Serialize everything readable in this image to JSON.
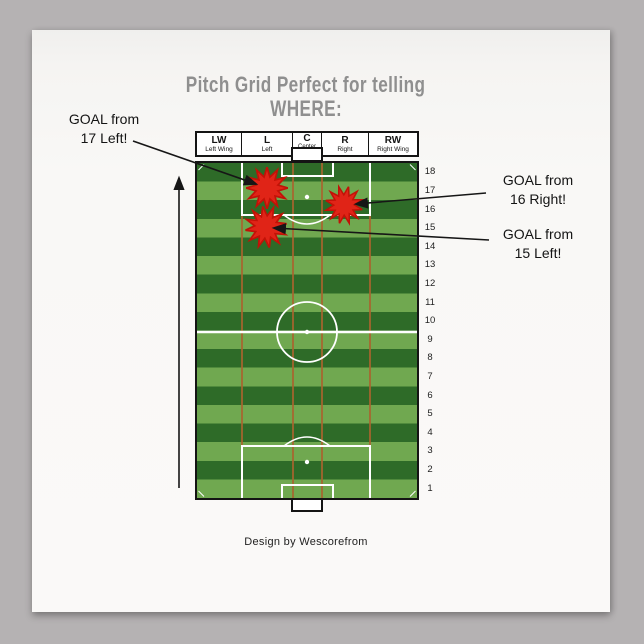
{
  "poster": {
    "title_line1": "Pitch Grid Perfect for telling",
    "title_line2": "WHERE:",
    "credit": "Design by Wescorefrom",
    "title_color": "#8f8f8f",
    "background_color": "#faf9f8",
    "page_background_color": "#b5b2b3"
  },
  "callouts": [
    {
      "line1": "GOAL from",
      "line2": "17 Left!"
    },
    {
      "line1": "GOAL from",
      "line2": "16 Right!"
    },
    {
      "line1": "GOAL from",
      "line2": "15 Left!"
    }
  ],
  "pitch": {
    "column_headers": [
      {
        "abbr": "LW",
        "label": "Left Wing"
      },
      {
        "abbr": "L",
        "label": "Left"
      },
      {
        "abbr": "C",
        "label": "Center"
      },
      {
        "abbr": "R",
        "label": "Right"
      },
      {
        "abbr": "RW",
        "label": "Right Wing"
      }
    ],
    "row_numbers": [
      "18",
      "17",
      "16",
      "15",
      "14",
      "13",
      "12",
      "11",
      "10",
      "9",
      "8",
      "7",
      "6",
      "5",
      "4",
      "3",
      "2",
      "1"
    ],
    "goal_markers": [
      {
        "row": "17",
        "column": "L"
      },
      {
        "row": "16",
        "column": "R"
      },
      {
        "row": "15",
        "column": "L"
      }
    ],
    "colors": {
      "stripe_dark": "#2e6b28",
      "stripe_light": "#70a850",
      "grid_line": "#a9642e",
      "marking_white": "#ffffff",
      "marker_red": "#e02417",
      "marker_red_edge": "#c11207",
      "border_black": "#141414"
    }
  }
}
